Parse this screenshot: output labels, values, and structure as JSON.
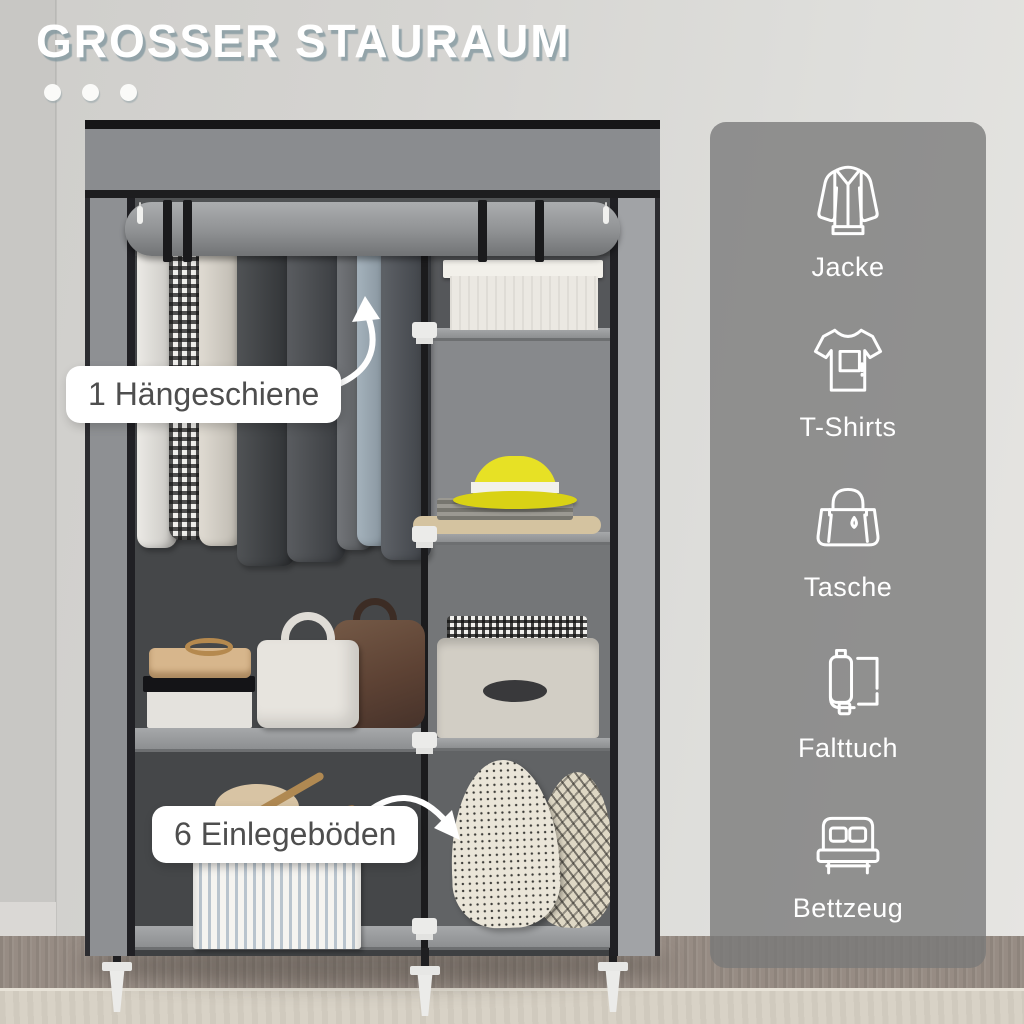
{
  "title": "GROSSER STAURAUM",
  "callouts": [
    {
      "label": "1 Hängeschiene"
    },
    {
      "label": "6 Einlegeböden"
    }
  ],
  "sidebar": {
    "items": [
      {
        "icon": "jacket-icon",
        "label": "Jacke"
      },
      {
        "icon": "tshirt-icon",
        "label": "T-Shirts"
      },
      {
        "icon": "tote-bag-icon",
        "label": "Tasche"
      },
      {
        "icon": "folded-cloth-icon",
        "label": "Falttuch"
      },
      {
        "icon": "bed-icon",
        "label": "Bettzeug"
      }
    ]
  },
  "colors": {
    "title_text": "#ffffff",
    "title_shadow": "#7e949c",
    "sidebar_overlay": "rgba(121,121,121,0.78)",
    "callout_bg": "#ffffff",
    "callout_text": "#4e4e4e",
    "accent_hat_yellow": "#e7e125",
    "wardrobe_fabric_gray": "#8e9093"
  }
}
